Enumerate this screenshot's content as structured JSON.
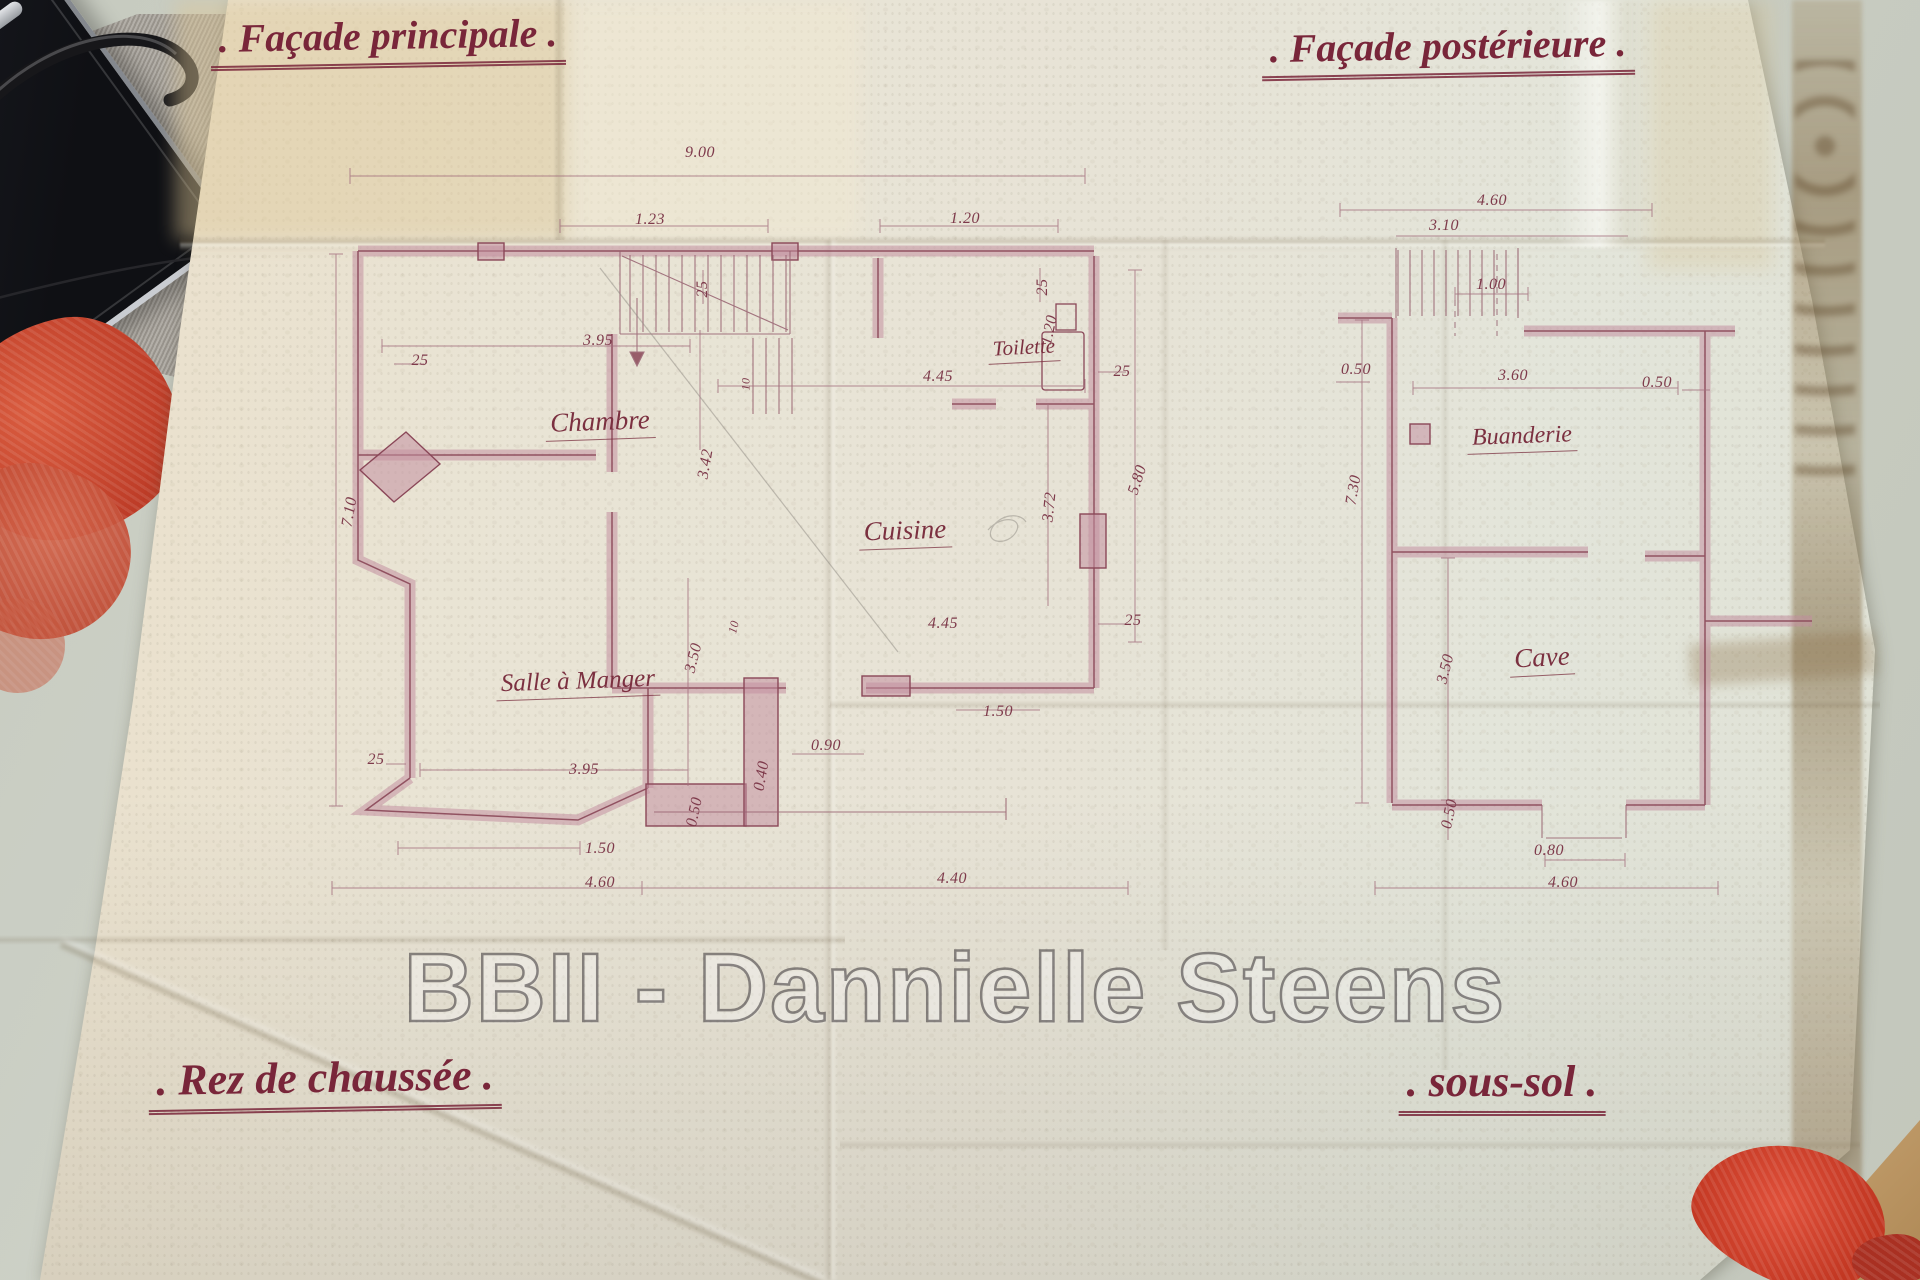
{
  "photo": {
    "watermark": "BBII - Dannielle Steens",
    "titles": {
      "facade_principale": ". Façade principale .",
      "facade_posterieure": ". Façade postérieure .",
      "rez_de_chaussee": ". Rez de chaussée .",
      "sous_sol": ". sous-sol ."
    },
    "ground_floor": {
      "rooms": {
        "chambre": "Chambre",
        "cuisine": "Cuisine",
        "toilette": "Toilette",
        "salle_a_manger": "Salle à Manger"
      },
      "dims": {
        "overall_width": "9.00",
        "bay_window_top": "1.23",
        "wall_top": "25",
        "window_right_top": "1.20",
        "wall_top_right": "25",
        "toilette_depth": "1.20",
        "wall_right": "25",
        "chambre_width": "3.95",
        "wall_left": "25",
        "chambre_depth": "3.42",
        "cuisine_width_top": "4.45",
        "cuisine_depth": "3.72",
        "east_height": "5.80",
        "west_height": "7.10",
        "salle_depth": "3.50",
        "wall_left_low": "25",
        "salle_width": "3.95",
        "bay_corner": "0.50",
        "cuisine_width_bottom": "4.45",
        "wall_right_low": "25",
        "back_door": "0.90",
        "pier_width": "0.40",
        "bay_width": "1.50",
        "terrace_door": "1.50",
        "south_west_width": "4.60",
        "south_east_width": "4.40",
        "offset_a": "10",
        "offset_b": "10"
      }
    },
    "basement": {
      "rooms": {
        "buanderie": "Buanderie",
        "cave": "Cave"
      },
      "dims": {
        "overall_top": "4.60",
        "inner_top": "3.10",
        "stair_opening": "1.00",
        "wall_left": "0.50",
        "inner_width": "3.60",
        "wall_right": "0.50",
        "west_height": "7.30",
        "cave_depth": "3.50",
        "wall_bottom": "0.50",
        "cellar_door": "0.80",
        "overall_bottom": "4.60"
      }
    }
  }
}
